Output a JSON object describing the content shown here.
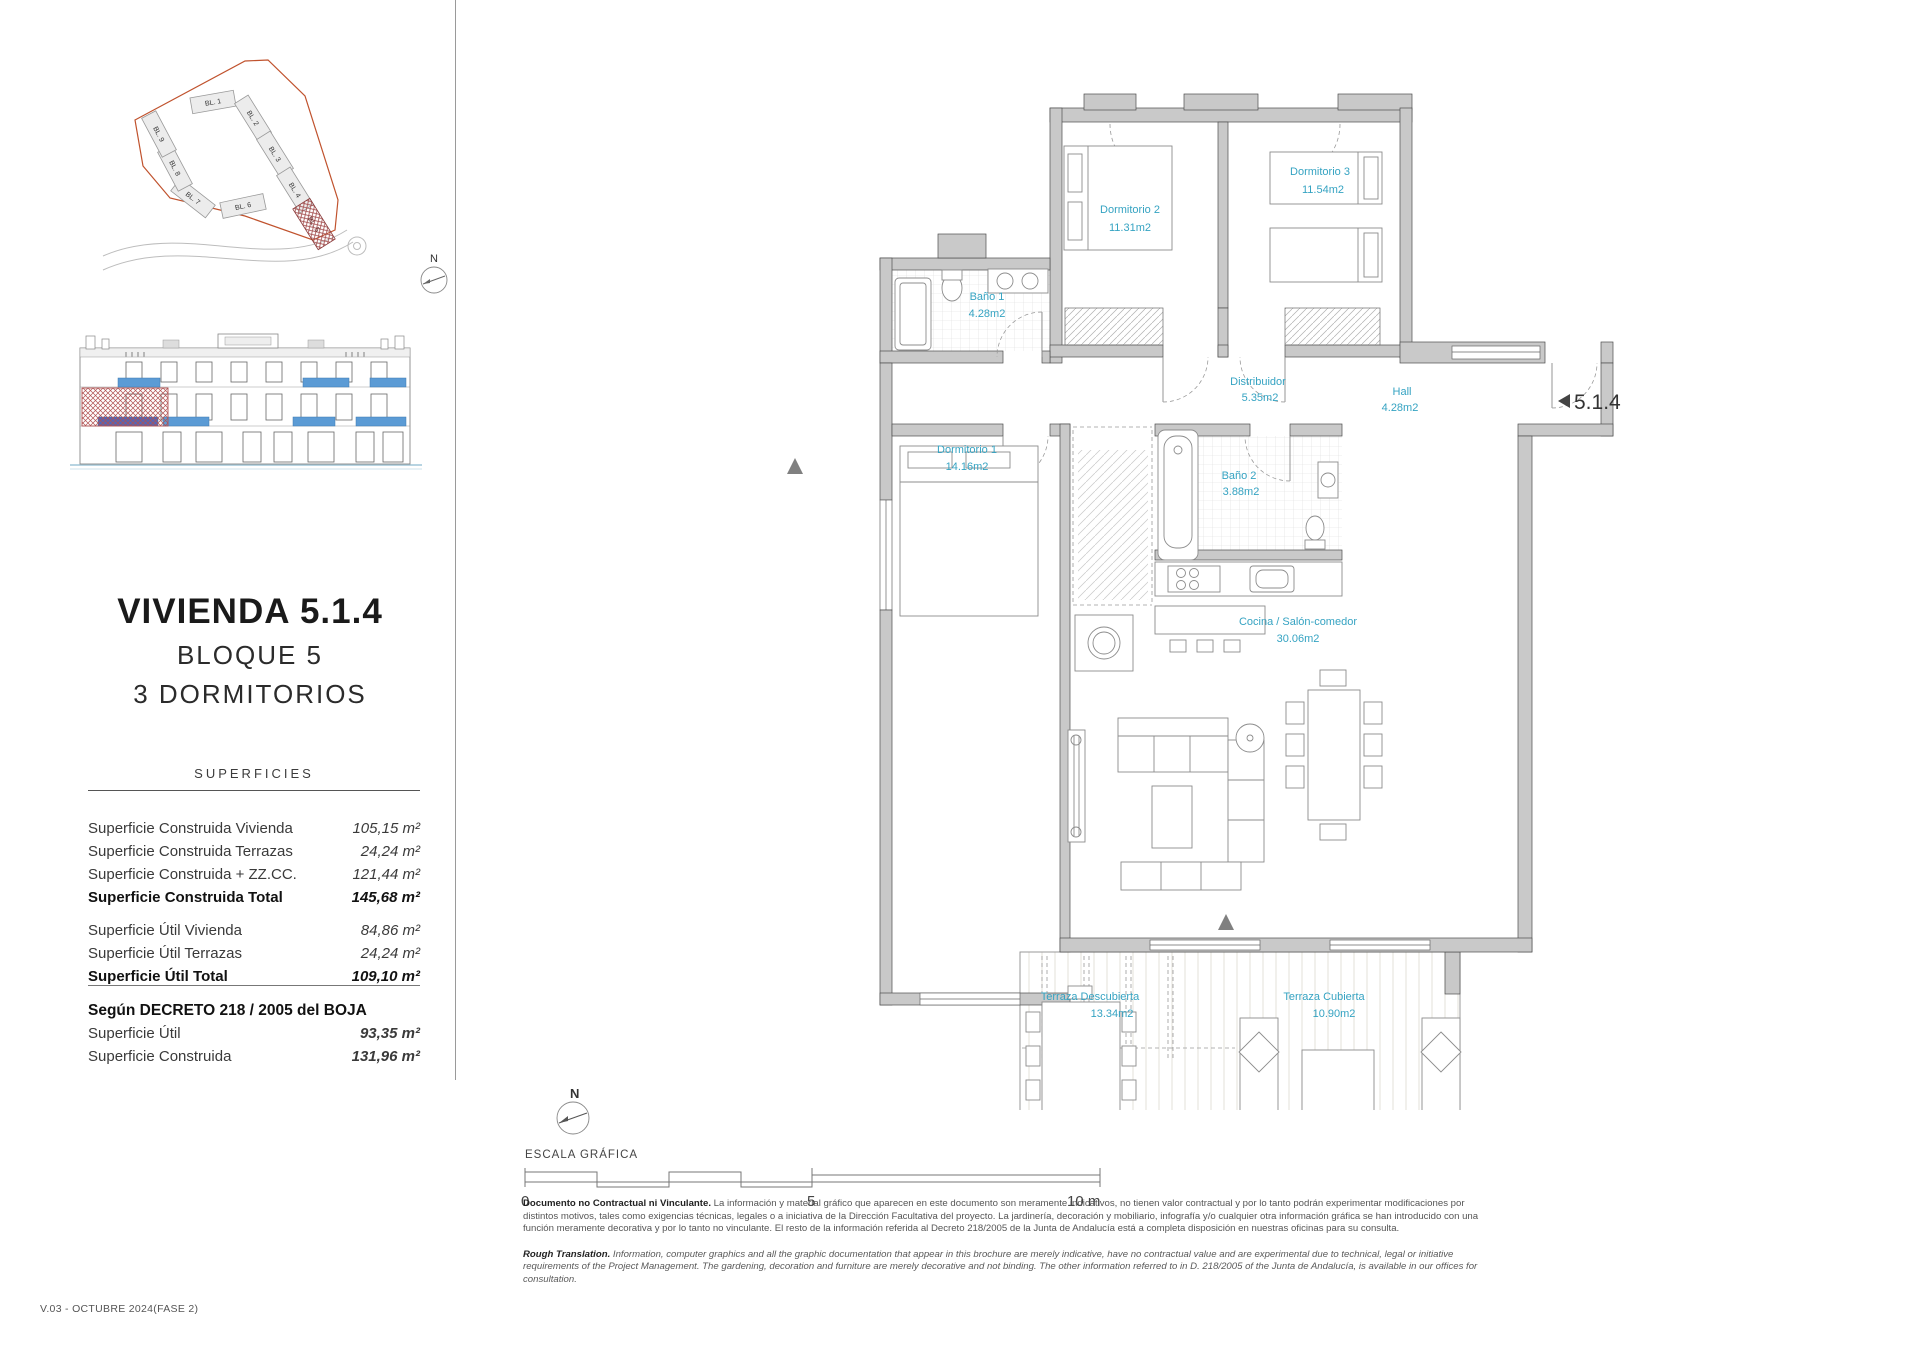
{
  "colors": {
    "accent_cyan": "#35a3c2",
    "wall_gray": "#c9c9c9",
    "window_blue": "#5b9bd5",
    "boundary_orange": "#c0522d",
    "hatch_red": "#a34d4d"
  },
  "sidebar": {
    "site_plan": {
      "north_label": "N",
      "blocks": [
        "BL. 1",
        "BL. 2",
        "BL. 3",
        "BL. 4",
        "BL. 5",
        "BL. 6",
        "BL. 7",
        "BL. 8",
        "BL. 9"
      ],
      "highlighted_block": "BL. 5"
    },
    "title": "VIVIENDA 5.1.4",
    "subtitle1": "BLOQUE 5",
    "subtitle2": "3 DORMITORIOS",
    "superficies": {
      "heading": "SUPERFICIES",
      "rows": [
        {
          "label": "Superficie Construida Vivienda",
          "value": "105,15 m²"
        },
        {
          "label": "Superficie Construida Terrazas",
          "value": "24,24 m²"
        },
        {
          "label": "Superficie Construida + ZZ.CC.",
          "value": "121,44 m²"
        },
        {
          "label": "Superficie Construida Total",
          "value": "145,68 m²"
        },
        {
          "label": "Superficie Útil Vivienda",
          "value": "84,86 m²"
        },
        {
          "label": "Superficie Útil Terrazas",
          "value": "24,24 m²"
        },
        {
          "label": "Superficie Útil Total",
          "value": "109,10 m²"
        }
      ]
    },
    "decreto": {
      "heading": "Según DECRETO 218 / 2005 del BOJA",
      "rows": [
        {
          "label": "Superficie Útil",
          "value": "93,35 m²"
        },
        {
          "label": "Superficie Construida",
          "value": "131,96 m²"
        }
      ]
    }
  },
  "floorplan": {
    "unit_label": "5.1.4",
    "rooms": [
      {
        "name": "Dormitorio 2",
        "area": "11.31m2"
      },
      {
        "name": "Dormitorio 3",
        "area": "11.54m2"
      },
      {
        "name": "Baño 1",
        "area": "4.28m2"
      },
      {
        "name": "Distribuidor",
        "area": "5.35m2"
      },
      {
        "name": "Hall",
        "area": "4.28m2"
      },
      {
        "name": "Dormitorio 1",
        "area": "14.16m2"
      },
      {
        "name": "Baño 2",
        "area": "3.88m2"
      },
      {
        "name": "Cocina / Salón-comedor",
        "area": "30.06m2"
      },
      {
        "name": "Terraza Descubierta",
        "area": "13.34m2"
      },
      {
        "name": "Terraza Cubierta",
        "area": "10.90m2"
      }
    ]
  },
  "scale": {
    "north_label": "N",
    "heading": "ESCALA GRÁFICA",
    "ticks": [
      "0",
      "5",
      "10 m"
    ]
  },
  "disclaimer": {
    "es_lead": "Documento no Contractual ni Vinculante.",
    "es_body": "La información y material gráfico que aparecen en este documento son meramente indicativos, no tienen valor contractual y por lo tanto podrán experimentar modificaciones por distintos motivos, tales como exigencias técnicas, legales o a iniciativa de la Dirección Facultativa del proyecto. La jardinería, decoración y mobiliario, infografía y/o cualquier otra información gráfica se han introducido con una función meramente decorativa y por lo tanto no vinculante. El resto de la información referida al Decreto 218/2005 de la Junta de Andalucía está a completa disposición en nuestras oficinas para su consulta.",
    "en_lead": "Rough Translation.",
    "en_body": "Information, computer graphics and all the graphic documentation that appear in this brochure are merely indicative, have no contractual value and are experimental due to technical, legal or initiative requirements of the Project Management. The gardening, decoration and furniture are merely decorative and not binding. The other information referred to in D. 218/2005 of the Junta de Andalucía, is available in our offices for consultation."
  },
  "version_label": "V.03 - OCTUBRE 2024(FASE 2)"
}
